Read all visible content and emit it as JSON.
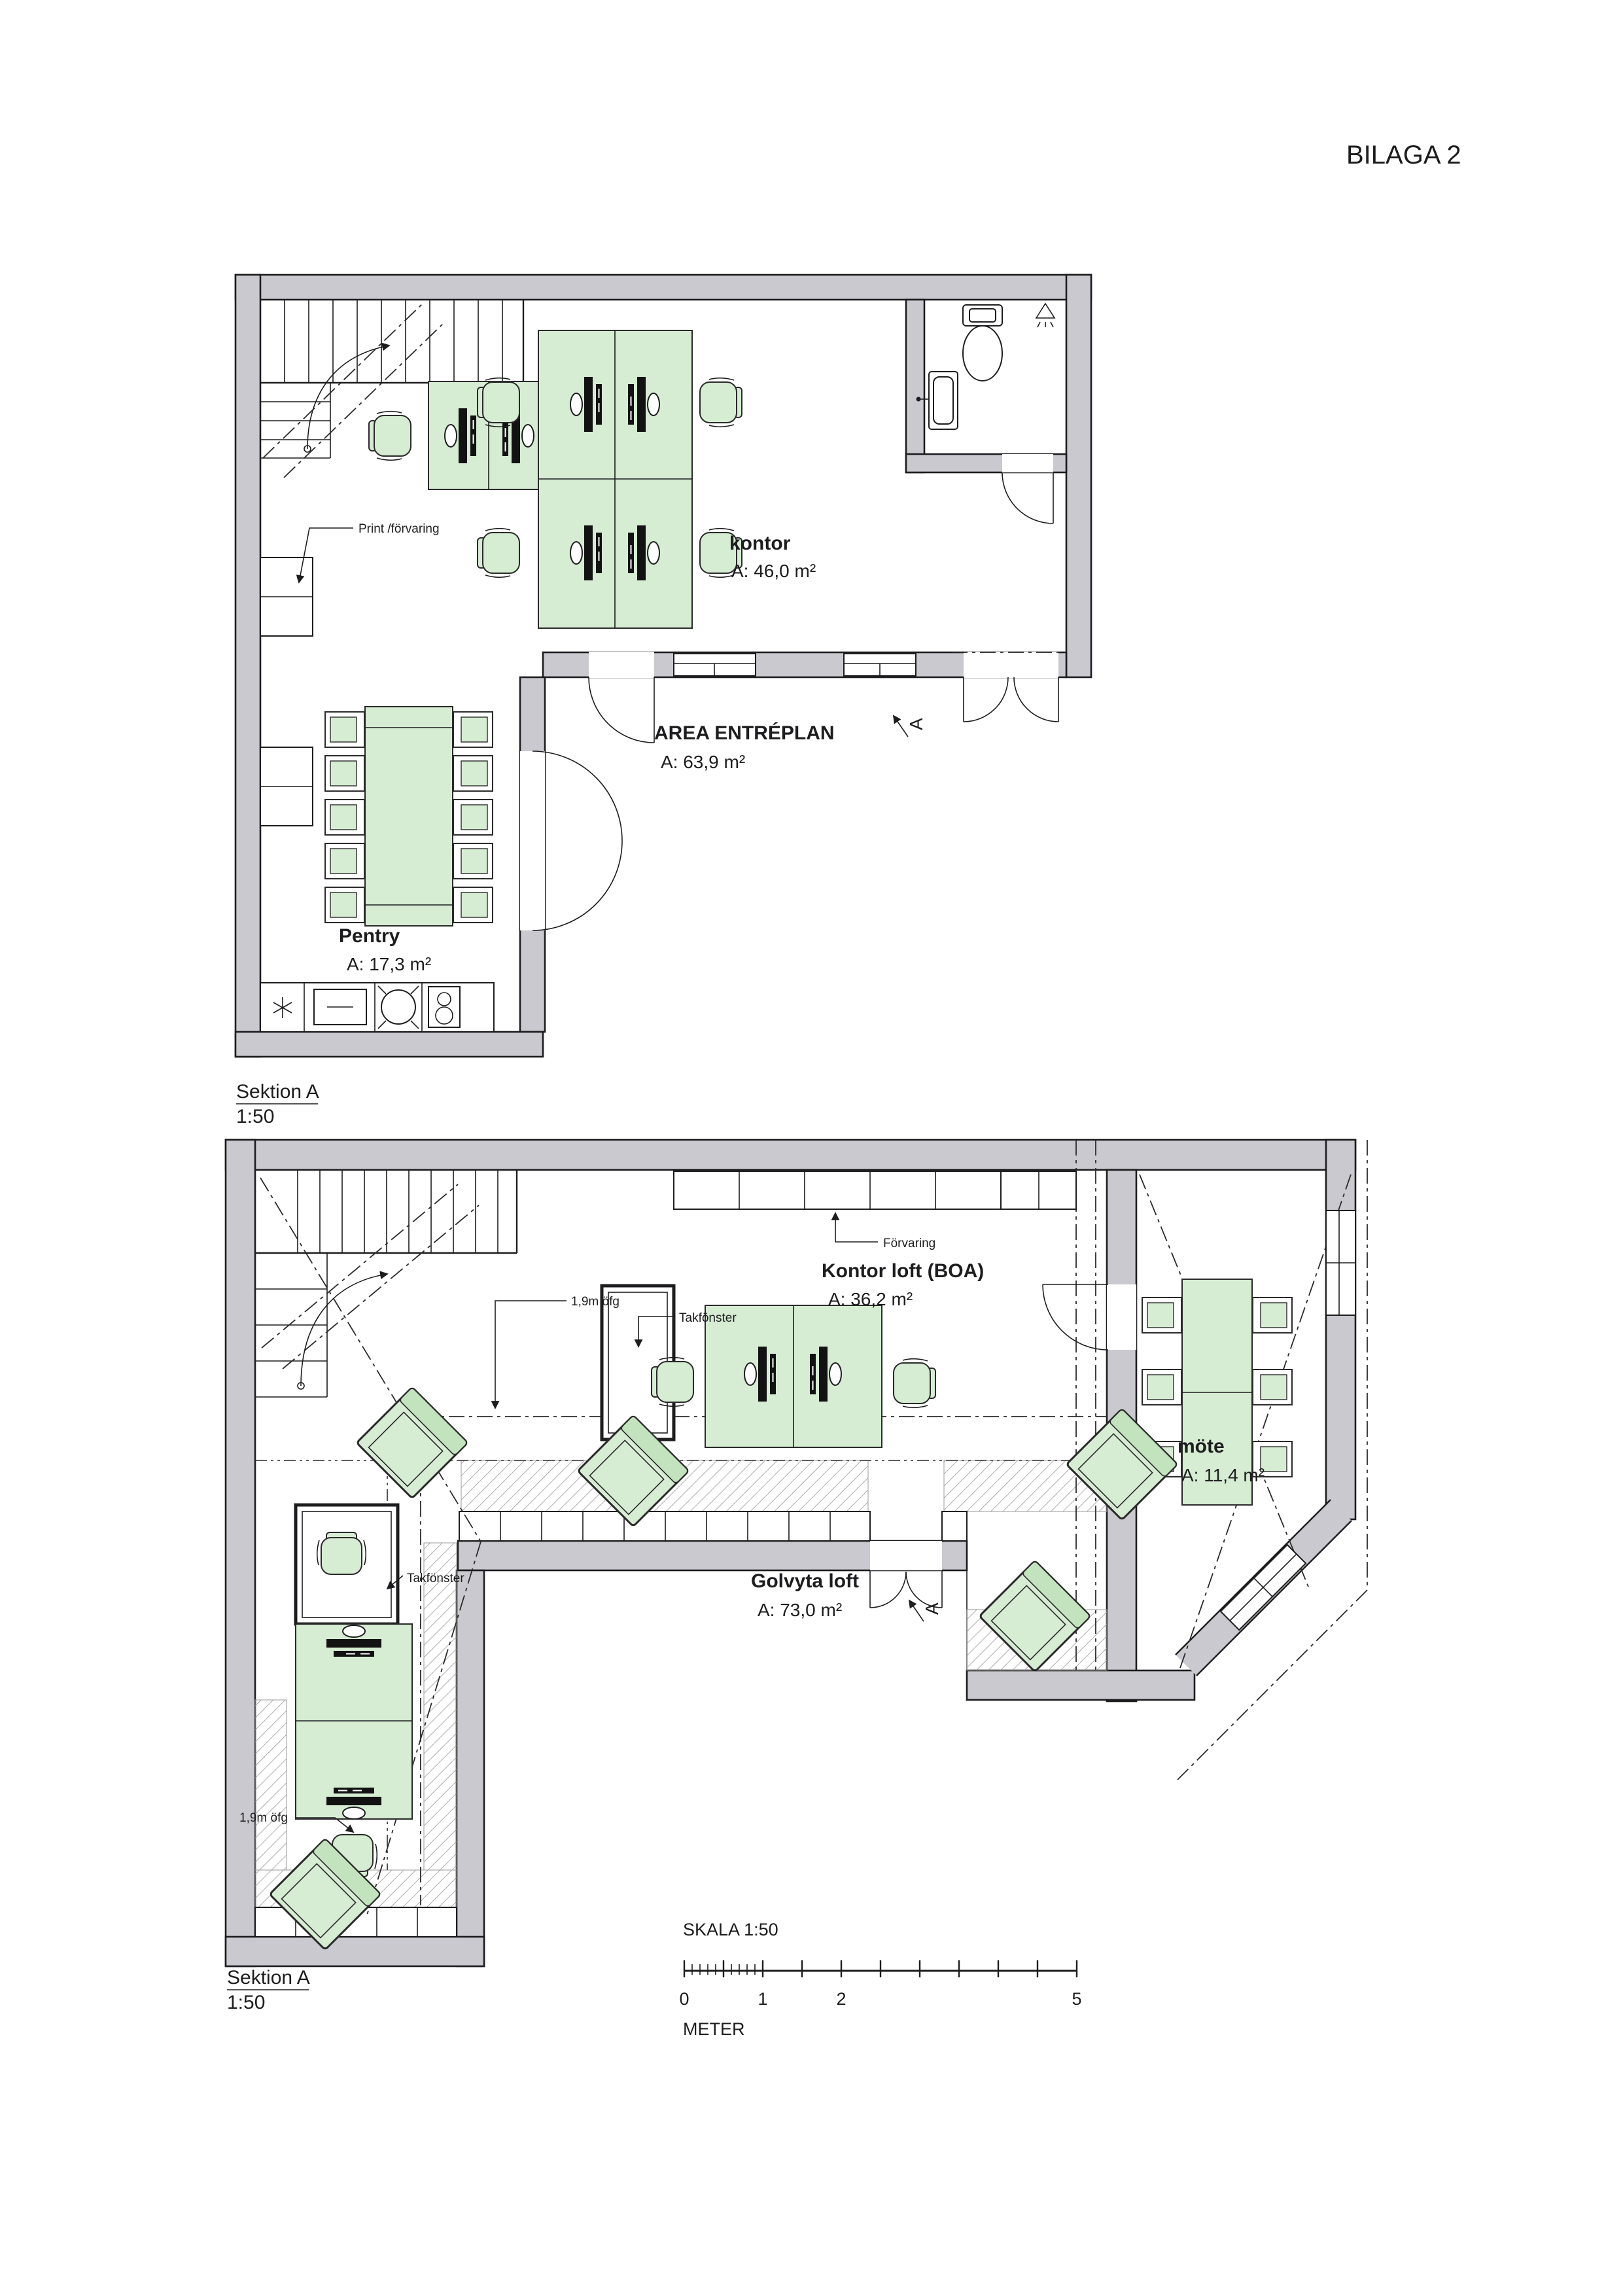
{
  "page": {
    "title": "BILAGA 2"
  },
  "colors": {
    "wall_fill": "#c9c9cf",
    "furniture_fill": "#d6ecd3",
    "line": "#1d1d1f",
    "hatch": "#8a8a8a"
  },
  "top_plan": {
    "section_label": "Sektion A",
    "section_scale": "1:50",
    "rooms": {
      "kontor": {
        "name": "kontor",
        "area": "A: 46,0 m²"
      },
      "entreplan": {
        "name": "AREA ENTRÉPLAN",
        "area": "A: 63,9 m²"
      },
      "pentry": {
        "name": "Pentry",
        "area": "A: 17,3 m²"
      }
    },
    "annotations": {
      "print_storage": "Print /förvaring",
      "section_marker": "A"
    }
  },
  "bottom_plan": {
    "section_label": "Sektion A",
    "section_scale": "1:50",
    "rooms": {
      "kontor_loft": {
        "name": "Kontor loft (BOA)",
        "area": "A: 36,2 m²"
      },
      "mote": {
        "name": "möte",
        "area": "A: 11,4 m²"
      },
      "golvyta_loft": {
        "name": "Golvyta loft",
        "area": "A: 73,0 m²"
      }
    },
    "annotations": {
      "storage": "Förvaring",
      "skylight_1": "Takfönster",
      "skylight_2": "Takfönster",
      "headroom_1": "1,9m öfg",
      "headroom_2": "1,9m öfg",
      "section_marker": "A"
    }
  },
  "scale_bar": {
    "title": "SKALA 1:50",
    "unit": "METER",
    "labels": [
      "0",
      "1",
      "2",
      "5"
    ]
  }
}
